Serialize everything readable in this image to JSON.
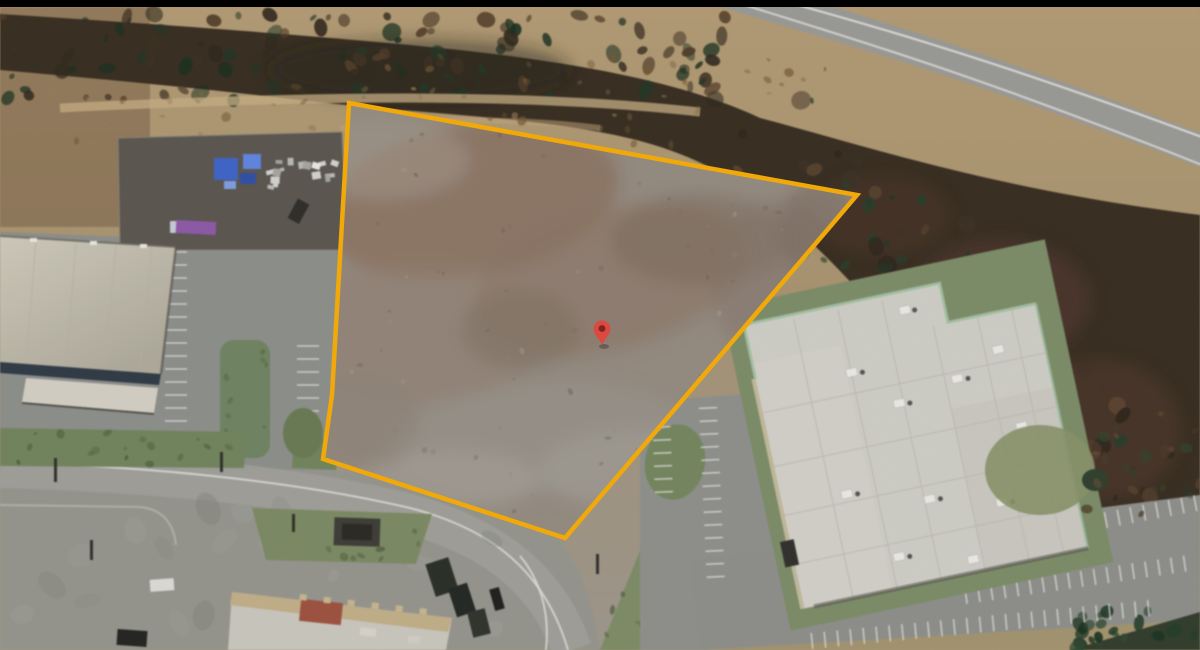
{
  "map": {
    "view_type": "satellite",
    "letterbox": {
      "color": "#000000",
      "height": 7
    },
    "parcel": {
      "outline_color": "#FFB000",
      "outline_width": 4.5,
      "points": "349,103 857,195 565,538 323,459 332,395 343,205"
    },
    "pin": {
      "x": 602,
      "y": 345,
      "color": "#E8453C",
      "dot_color": "#7A1F18"
    }
  }
}
